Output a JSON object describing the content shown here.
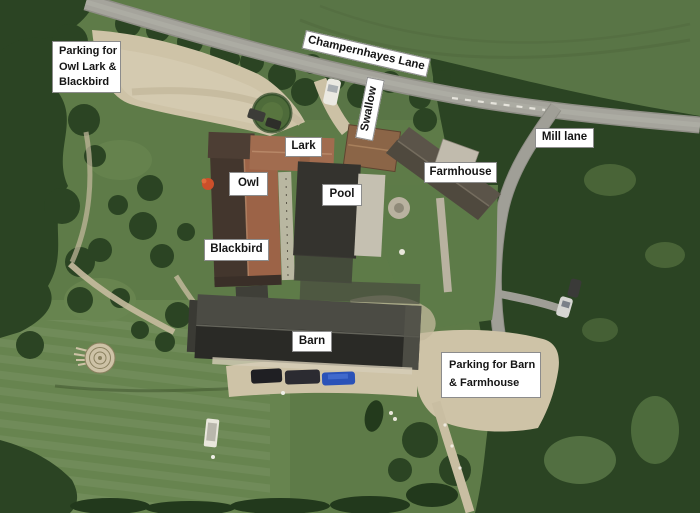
{
  "palette": {
    "label_bg": "#ffffff",
    "label_border": "#8c8c8c",
    "label_text": "#151515",
    "grass": "#5e7b48",
    "grass_light": "#688550",
    "tree_dark": "#2b4423",
    "road": "#a5a49c",
    "driveway": "#cec3a7",
    "roof_terracotta": "#9c6347",
    "roof_dark": "#34332e",
    "roof_farmhouse": "#5b5449",
    "car_blue": "#2a52b8"
  },
  "map_labels": {
    "parking_owl": {
      "lines": [
        "Parking for",
        "Owl Lark &",
        "Blackbird"
      ]
    },
    "champernhayes": {
      "text": "Champernhayes Lane"
    },
    "swallow": {
      "text": "Swallow"
    },
    "mill_lane": {
      "text": "Mill lane"
    },
    "lark": {
      "text": "Lark"
    },
    "farmhouse": {
      "text": "Farmhouse"
    },
    "owl": {
      "text": "Owl"
    },
    "pool": {
      "text": "Pool"
    },
    "blackbird": {
      "text": "Blackbird"
    },
    "barn": {
      "text": "Barn"
    },
    "parking_barn": {
      "lines": [
        "Parking for Barn",
        "& Farmhouse"
      ]
    }
  }
}
